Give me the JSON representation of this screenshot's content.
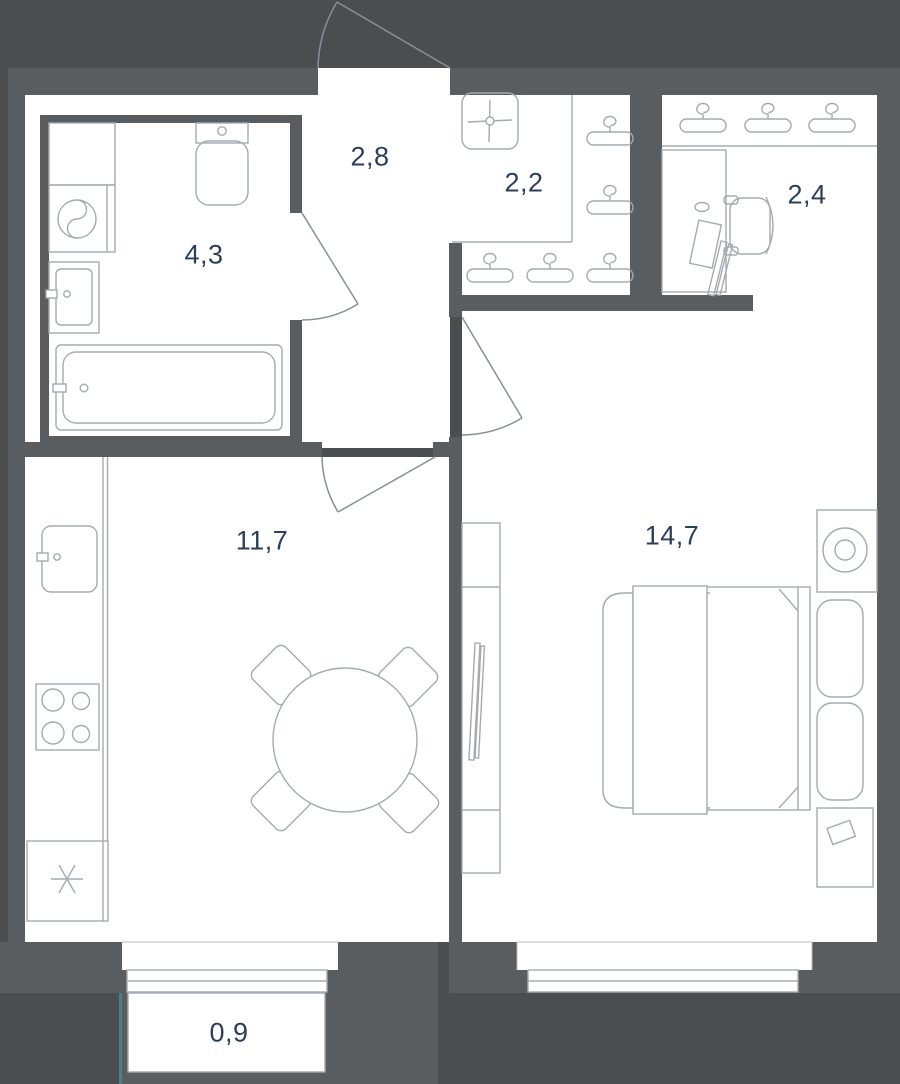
{
  "plan": {
    "title": "apartment-floor-plan",
    "rooms": [
      {
        "id": "bathroom",
        "area": "4,3"
      },
      {
        "id": "hallway",
        "area": "2,8"
      },
      {
        "id": "wardrobe",
        "area": "2,2"
      },
      {
        "id": "workspace",
        "area": "2,4"
      },
      {
        "id": "kitchen-living-room",
        "area": "11,7"
      },
      {
        "id": "bedroom",
        "area": "14,7"
      },
      {
        "id": "balcony",
        "area": "0,9"
      }
    ],
    "colors": {
      "background": "#4C4D4F",
      "wall": "#5A5D60",
      "floor": "#FFFFFF",
      "furniture_line": "#A4ABB0",
      "door_line": "#879096",
      "label_text": "#2C3E58",
      "balcony_accent": "#4A7E8C"
    }
  }
}
